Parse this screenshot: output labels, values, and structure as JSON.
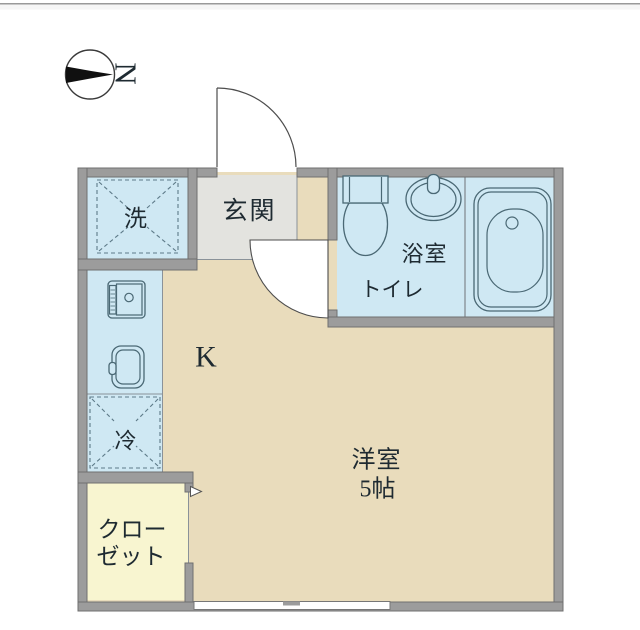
{
  "compass": {
    "north_label": "N"
  },
  "rooms": {
    "entrance_label": "玄関",
    "washer_label": "洗",
    "bathroom_label": "浴室",
    "toilet_label": "トイレ",
    "kitchen_label": "K",
    "fridge_label": "冷",
    "closet_label_line1": "クロー",
    "closet_label_line2": "ゼット",
    "main_room_label": "洋室",
    "main_room_size": "5帖"
  },
  "colors": {
    "floor": "#e9dcbc",
    "wet_area": "#cfe8f3",
    "entrance_floor": "#e3e3df",
    "closet_floor": "#f8f5d0",
    "wall": "#9c9c9c",
    "fixture_outline": "#4a6874",
    "label_text": "#1e2a31"
  }
}
